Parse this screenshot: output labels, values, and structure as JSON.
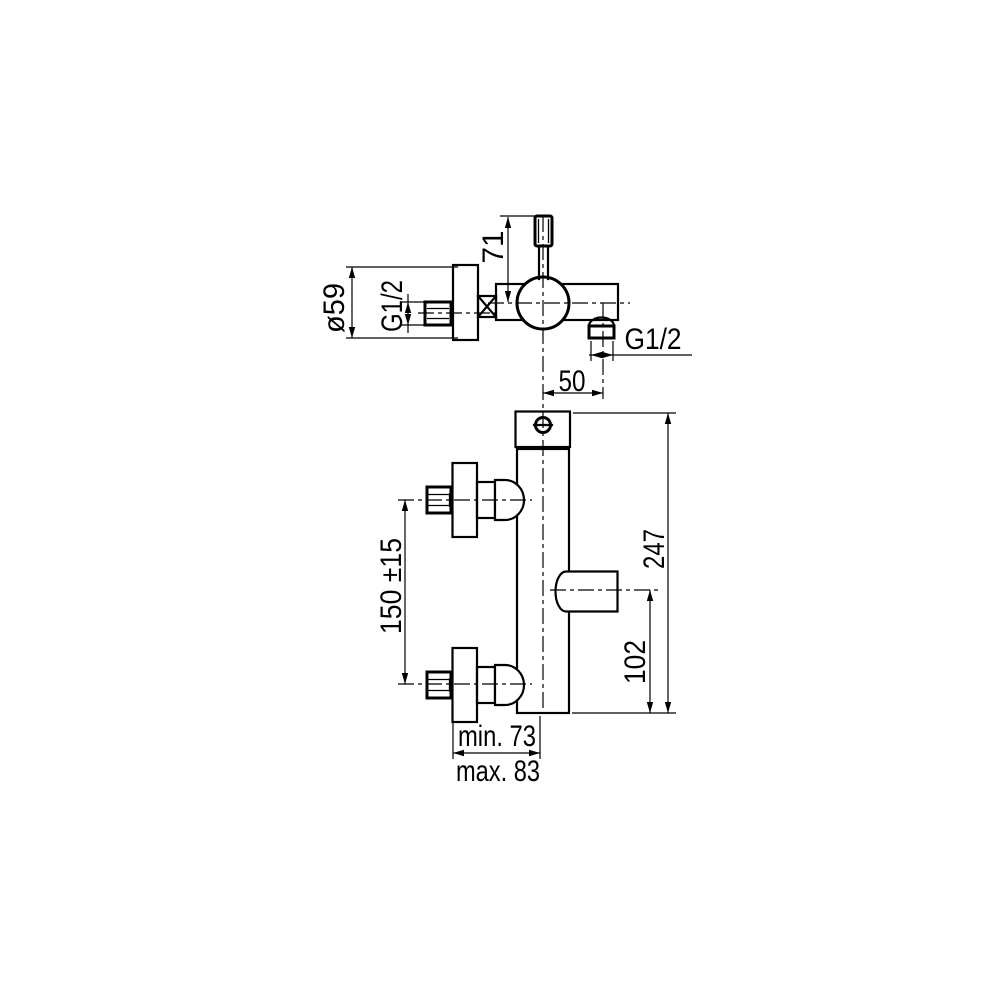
{
  "drawing": {
    "type": "technical-dimension-drawing",
    "subject": "wall-mounted single-lever bath/shower mixer faucet",
    "background_color": "#ffffff",
    "line_color": "#000000",
    "views": [
      {
        "name": "side-view",
        "dimension_ids": [
          "lever_height",
          "plate_diameter",
          "inlet_thread",
          "spout_thread",
          "spout_offset"
        ]
      },
      {
        "name": "front-view",
        "dimension_ids": [
          "connection_spacing",
          "overall_height",
          "spout_height",
          "depth_min",
          "depth_max"
        ]
      }
    ]
  },
  "dims": {
    "lever_height": "71",
    "plate_diameter": "ø59",
    "inlet_thread": "G1/2",
    "spout_thread": "G1/2",
    "spout_offset": "50",
    "connection_spacing": "150 ±15",
    "overall_height": "247",
    "spout_height": "102",
    "depth_min": "min. 73",
    "depth_max": "max. 83"
  }
}
